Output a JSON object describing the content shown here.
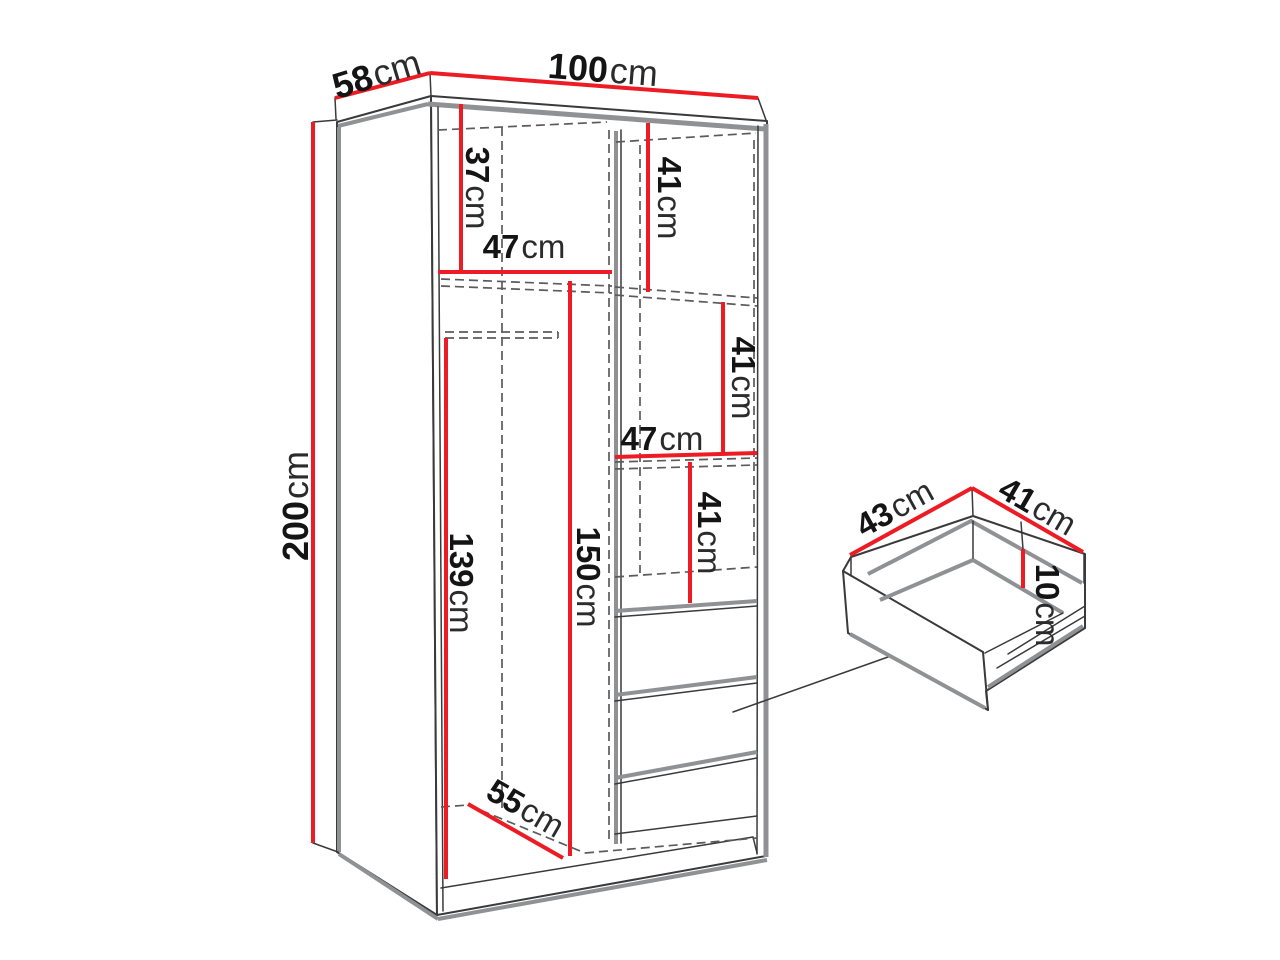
{
  "colors": {
    "dimension_red": "#ed1c24",
    "outline": "#3a3a3a",
    "accent_gray": "#8f9193",
    "hidden_line": "#5b5b5b",
    "label_text": "#141414",
    "background": "#ffffff"
  },
  "wardrobe": {
    "depth": {
      "value": "58",
      "unit": "cm"
    },
    "width": {
      "value": "100",
      "unit": "cm"
    },
    "height": {
      "value": "200",
      "unit": "cm"
    },
    "interior": {
      "top_left_section_height": {
        "value": "37",
        "unit": "cm"
      },
      "left_shelf_width": {
        "value": "47",
        "unit": "cm"
      },
      "right_top_section_height": {
        "value": "41",
        "unit": "cm"
      },
      "right_mid_section_height": {
        "value": "41",
        "unit": "cm"
      },
      "right_shelf_width": {
        "value": "47",
        "unit": "cm"
      },
      "right_lower_section_height": {
        "value": "41",
        "unit": "cm"
      },
      "rod_to_floor_height": {
        "value": "139",
        "unit": "cm"
      },
      "left_section_height": {
        "value": "150",
        "unit": "cm"
      },
      "interior_depth": {
        "value": "55",
        "unit": "cm"
      }
    }
  },
  "drawer_detail": {
    "depth": {
      "value": "43",
      "unit": "cm"
    },
    "width": {
      "value": "41",
      "unit": "cm"
    },
    "height": {
      "value": "10",
      "unit": "cm"
    }
  }
}
